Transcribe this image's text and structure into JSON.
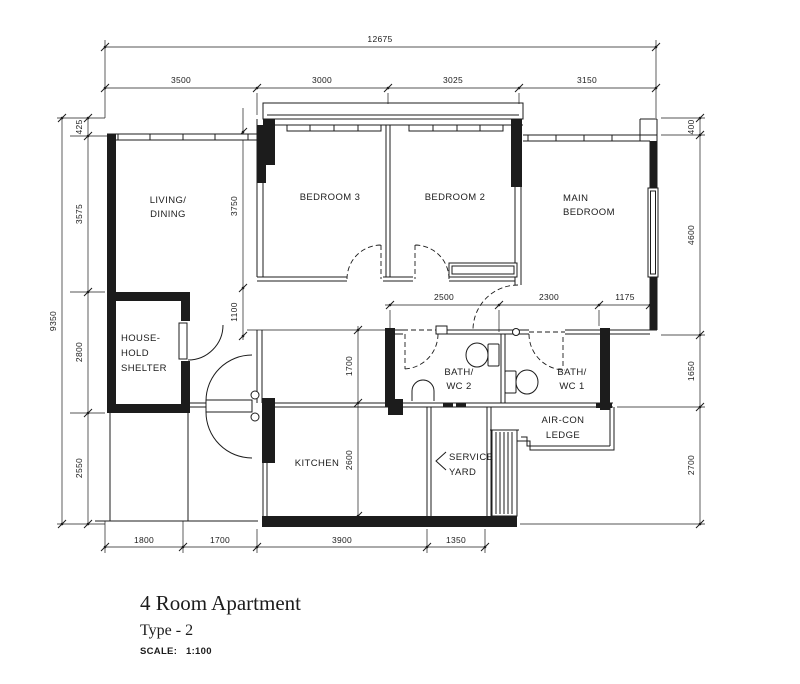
{
  "colors": {
    "ink": "#1c1c1c",
    "paper": "#ffffff"
  },
  "title": {
    "name": "4 Room Apartment",
    "type": "Type - 2",
    "scale_label": "SCALE:",
    "scale_value": "1:100"
  },
  "rooms": {
    "living_dining": [
      "LIVING/",
      "DINING"
    ],
    "bedroom3": "BEDROOM  3",
    "bedroom2": "BEDROOM  2",
    "main_bedroom": [
      "MAIN",
      "BEDROOM"
    ],
    "household_shelter": [
      "HOUSE-",
      "HOLD",
      "SHELTER"
    ],
    "bath_wc2": [
      "BATH/",
      "WC  2"
    ],
    "bath_wc1": [
      "BATH/",
      "WC  1"
    ],
    "aircon_ledge": [
      "AIR-CON",
      "LEDGE"
    ],
    "kitchen": "KITCHEN",
    "service_yard": [
      "SERVICE",
      "YARD"
    ]
  },
  "dims": {
    "overall_width": "12675",
    "top_segments": [
      "3500",
      "3000",
      "3025",
      "3150"
    ],
    "overall_height": "9350",
    "left_segments": [
      "425",
      "3575",
      "2800",
      "2550"
    ],
    "right_segments": [
      "400",
      "4600",
      "1650",
      "2700"
    ],
    "bottom_segments": [
      "1800",
      "1700",
      "3900",
      "1350"
    ],
    "bedroom3_depth": "3750",
    "corridor_offset": "1100",
    "bath2_width": "2500",
    "bath1_width": "2300",
    "ledge_offset": "1175",
    "hall_width": "1700",
    "kitchen_depth": "2600"
  }
}
